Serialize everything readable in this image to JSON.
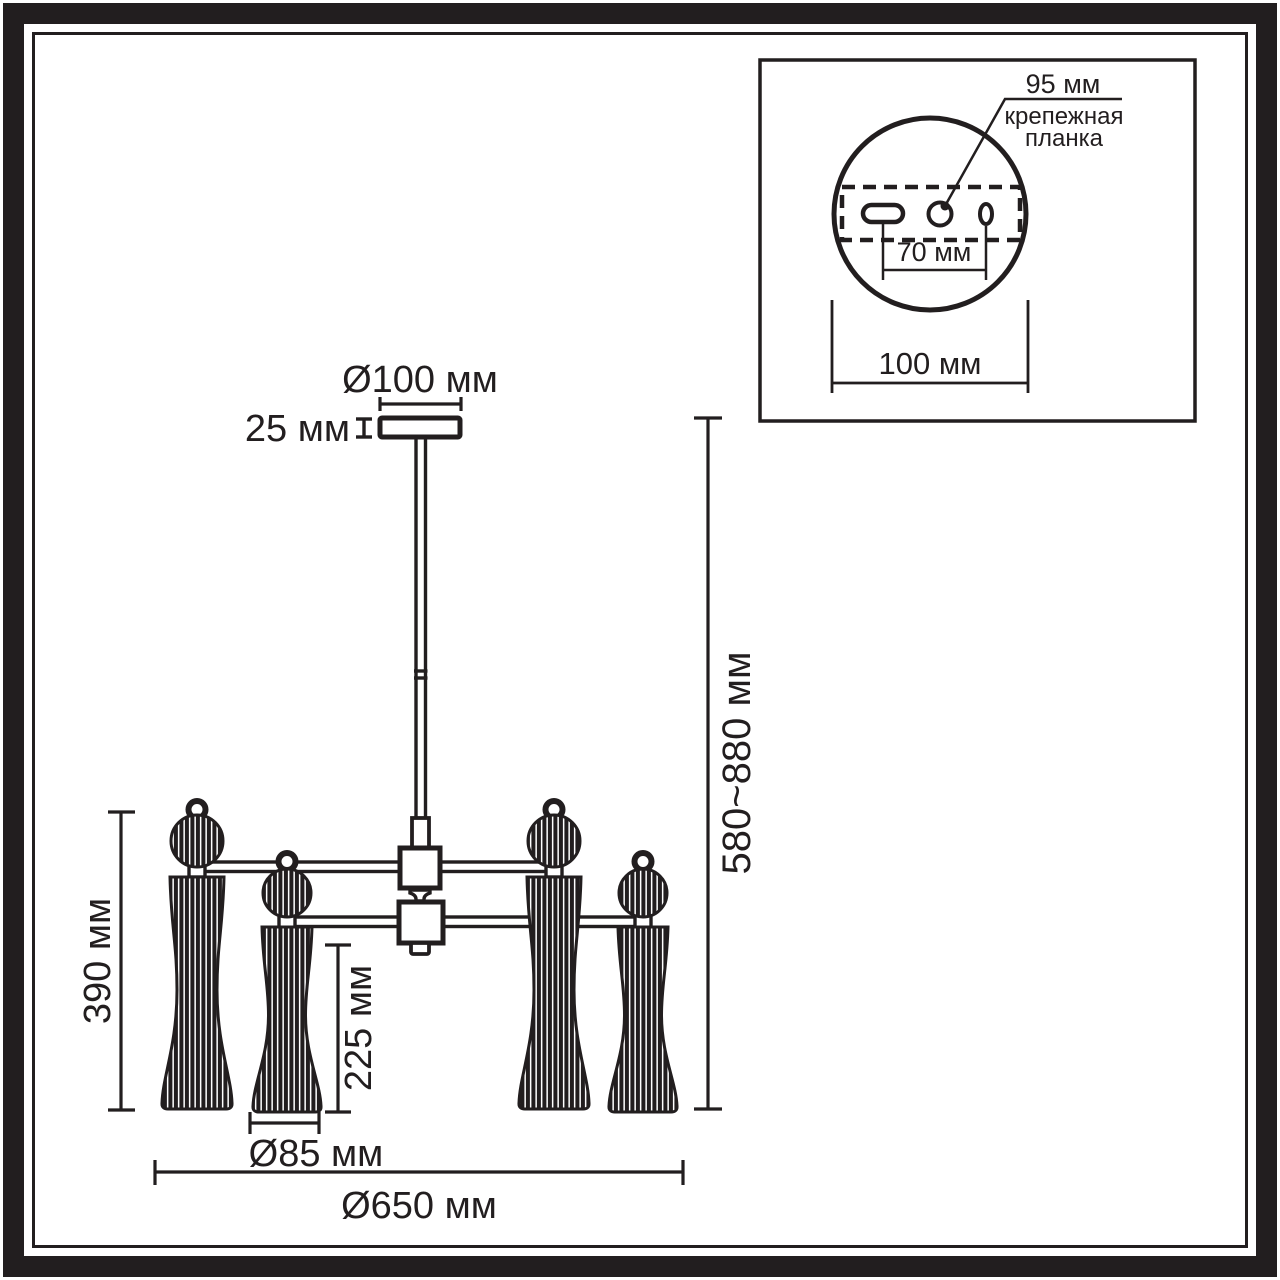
{
  "palette": {
    "ink": "#221e1f",
    "paper": "#ffffff"
  },
  "main_view": {
    "dimensions": {
      "canopy_diameter": "Ø100 мм",
      "canopy_height": "25 мм",
      "overall_height": "580~880 мм",
      "lamp_height": "390 мм",
      "shade_height": "225 мм",
      "shade_diameter": "Ø85 мм",
      "fixture_diameter": "Ø650 мм"
    }
  },
  "inset_view": {
    "dimensions": {
      "bracket_length": "95 мм",
      "hole_spacing": "70 мм",
      "canopy_diameter": "100 мм"
    },
    "labels": {
      "bracket_line1": "крепежная",
      "bracket_line2": "планка"
    }
  }
}
